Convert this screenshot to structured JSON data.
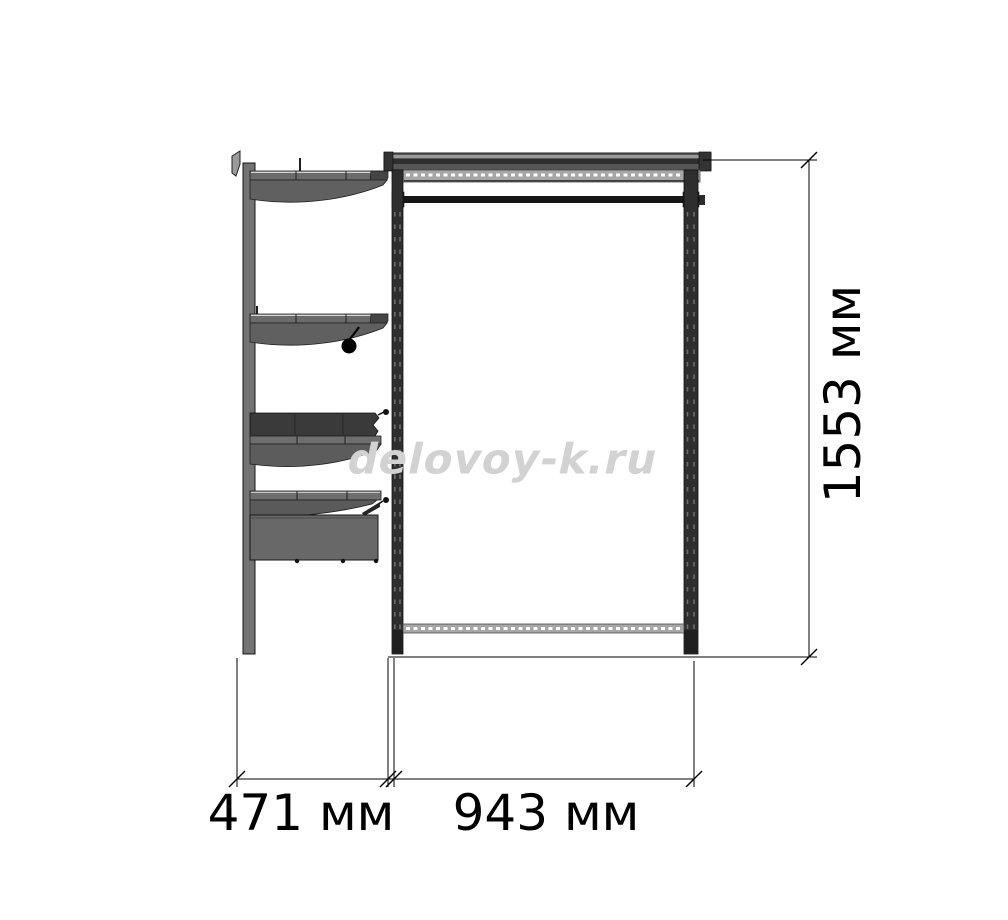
{
  "watermark": {
    "text": "delovoy-k.ru",
    "color": "#d2d2d2"
  },
  "dimensions": {
    "height": {
      "label": "1553 мм",
      "value_mm": 1553,
      "unit": "мм",
      "orientation": "vertical"
    },
    "side_section_width": {
      "label": "471 мм",
      "value_mm": 471,
      "unit": "мм",
      "orientation": "horizontal"
    },
    "front_section_width": {
      "label": "943 мм",
      "value_mm": 943,
      "unit": "мм",
      "orientation": "horizontal"
    }
  },
  "drawing": {
    "description": "Side and front elevation of a wall-mounted wardrobe shelving system with shelves, drawer, basket, perforated posts and hanging rod",
    "line_color": "#000000",
    "metal_light": "#a6a6a6",
    "metal_mid": "#6b6b6b",
    "metal_dark": "#2e2e2e"
  }
}
